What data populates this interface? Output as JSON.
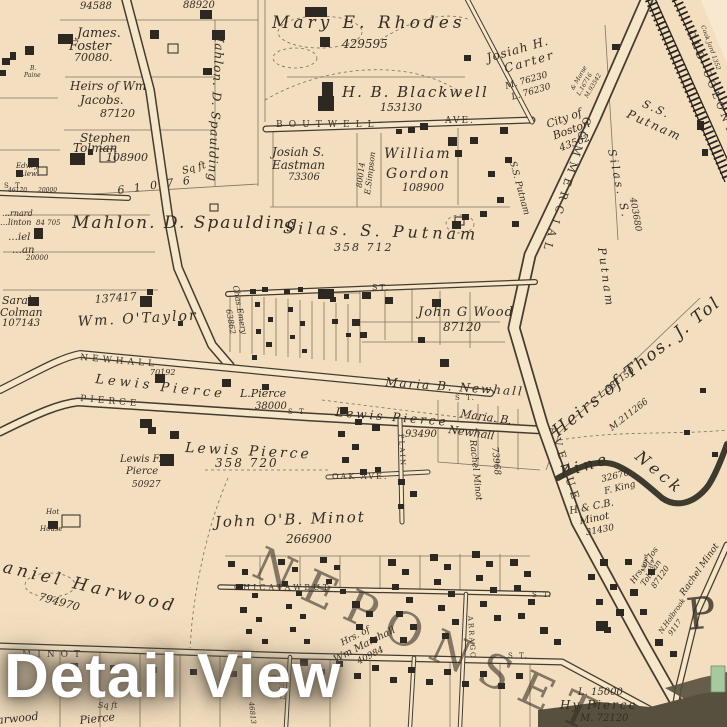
{
  "overlay": {
    "title": "Detail View"
  },
  "streets": {
    "boutwell": "BOUTWELL",
    "boutwell_ave": "AVE.",
    "commercial": "COMMERCIAL",
    "avenue": "AVENUE",
    "newhall": "NEWHALL",
    "pierce": "PIERCE",
    "oak_ave": "OAK AVE.",
    "plain": "PLAIN",
    "chicatawbut": "CHICATAWBUT",
    "minot": "MINOT",
    "old_colony": "OLD COLONY",
    "neponset": "NEPONSET",
    "arrago": "ARRAGO",
    "big_p": "P",
    "st": [
      "S T.",
      "ST.",
      "S T.",
      "S T.",
      "S T.",
      "S T."
    ]
  },
  "parcels": {
    "n94588": "94588",
    "n88920": "88920",
    "james_foster": [
      "James.",
      "Foster",
      "70080."
    ],
    "jacobs": [
      "Heirs of Wm",
      "Jacobs.",
      "87120"
    ],
    "stephen_tolman": [
      "Stephen",
      "Tolman",
      "108900"
    ],
    "spaulding_strip": [
      "Mahlon. D. Spaulding",
      "Sq ft",
      "6 1 0 7 6"
    ],
    "rhodes": [
      "Mary E. Rhodes",
      "429595"
    ],
    "blackwell": [
      "H. B. Blackwell",
      "153130"
    ],
    "eastman": [
      "Josiah S.",
      "Eastman",
      "73306"
    ],
    "simpson": [
      "E.Simpson",
      "80014"
    ],
    "gordon": [
      "William",
      "Gordon",
      "108900"
    ],
    "carter": [
      "Josiah H.",
      "Carter",
      "M. 76230",
      "L. 76230"
    ],
    "morse": [
      "& Morse",
      "L.16716",
      "M.93542"
    ],
    "city_boston": [
      "City of",
      "Boston",
      "43562"
    ],
    "ss_putnam_road": "S.S. Putnam",
    "ss_putnam": [
      "S.S.",
      "Putnam"
    ],
    "silas_vertical": [
      "Silas. S.",
      "Putnam",
      "403680"
    ],
    "cook": "Cook Jard 1352",
    "spaulding_big": "Mahlon. D. Spaulding",
    "silas_big": [
      "Silas. S. Putnam",
      "358 712"
    ],
    "paine": [
      "B.",
      "Paine"
    ],
    "llewellyn": [
      "Edw. J.",
      "Llewi",
      "46120",
      "20000"
    ],
    "clinton": [
      "…rnard",
      "…linton",
      "84 705"
    ],
    "daniel": [
      "…iel",
      "…an",
      "20000"
    ],
    "colman": [
      "Sarah",
      "Colman",
      "107143"
    ],
    "taylor": [
      "137417",
      "Wm. O'Taylor"
    ],
    "emery": [
      "Chas.Emery",
      "63862"
    ],
    "newhall_num": "70192",
    "lewis_pierce_newhall": [
      "Lewis",
      "Pierce"
    ],
    "l_pierce": [
      "L.Pierce",
      "38000"
    ],
    "wood": [
      "John G Wood",
      "87120"
    ],
    "maria_newhall_1": "Maria B. Newhall",
    "maria_newhall_2": [
      "Maria. B.",
      "Newhall"
    ],
    "lewis_pierce_93490": [
      "Lewis Pierce",
      "93490"
    ],
    "rachel_minot_v": "Rachel Minot",
    "n73968": "73968",
    "heirs_thos_tolman": "Heirs of Thos. J. Tol",
    "l381150": "L.381150",
    "m211266": "M.211266",
    "pine_neck": [
      "Pine",
      "Neck"
    ],
    "king": [
      "32670",
      "F. King"
    ],
    "hcb_minot": [
      "H & C.B.",
      "Minot",
      "31430"
    ],
    "jos_tolman": [
      "Hrs. of Jos",
      "Tolman",
      "87120"
    ],
    "rachel_minot_2": "Rachel Minot",
    "holbrook": [
      "N.Holbrook",
      "9117"
    ],
    "minot_hrs": [
      "Minot",
      "Hrs"
    ],
    "jb_minot": [
      "John O'B. Minot",
      "266900"
    ],
    "harwood": [
      "Daniel Harwood",
      "794970"
    ],
    "hot_house": [
      "Hot",
      "House"
    ],
    "lewis_f_pierce": [
      "Lewis F.",
      "Pierce",
      "50927"
    ],
    "lewis_pierce_358720": [
      "Lewis Pierce",
      "358 720"
    ],
    "marshall": [
      "Hrs. of",
      "Wm Marshall",
      "40984"
    ],
    "hy_pierce": [
      "L. 15000",
      "Hy Pierce",
      "M. 72120"
    ],
    "sqft": "Sq ft",
    "harwood_pierce": [
      "Harwood",
      "Pierce"
    ],
    "n37212": "37212",
    "n46813": "46813"
  }
}
